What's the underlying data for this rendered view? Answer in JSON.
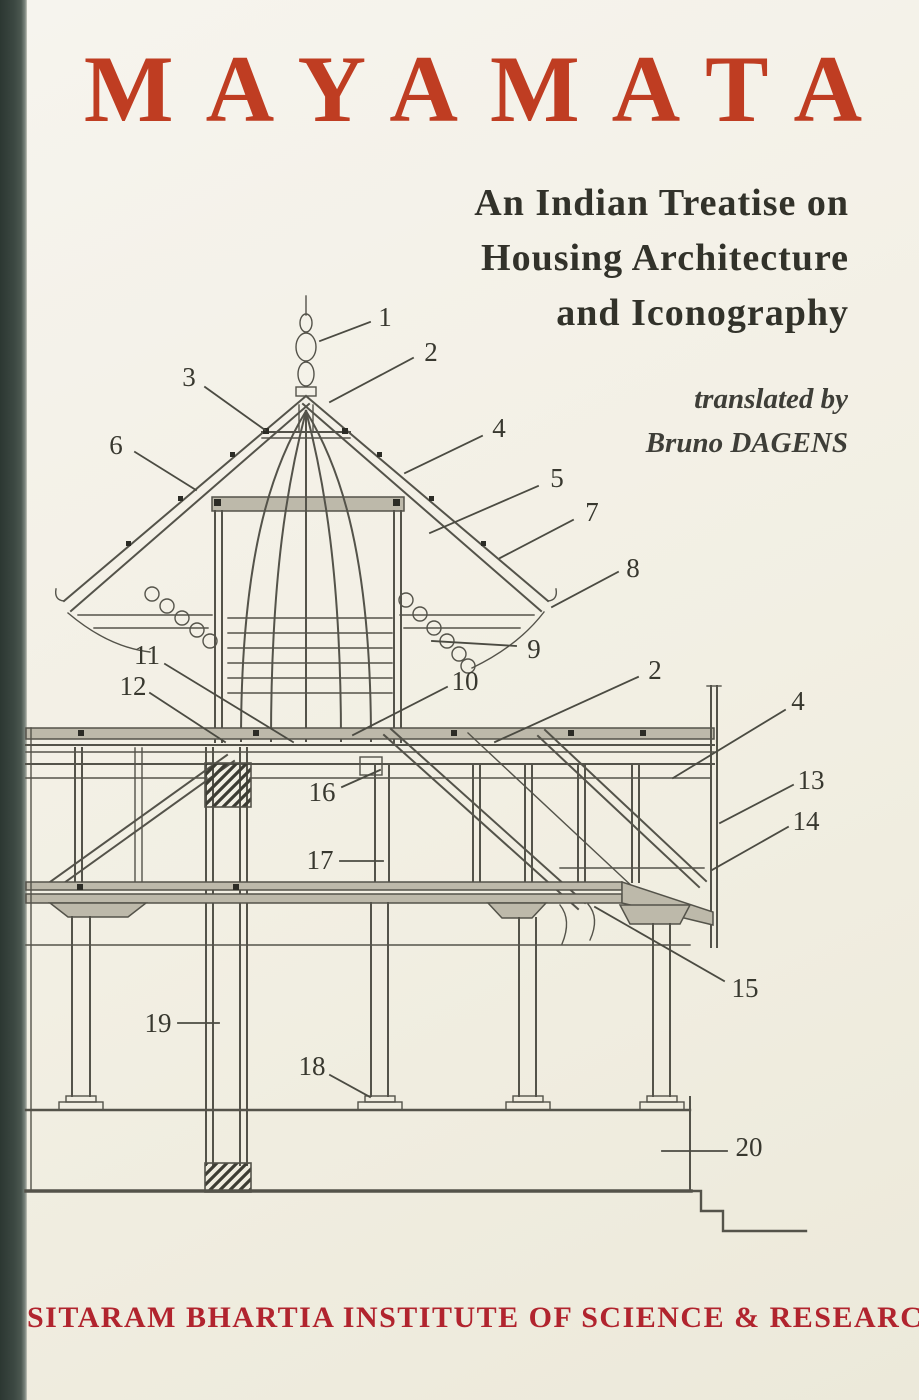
{
  "cover": {
    "title": "MAYAMATA",
    "subtitle": {
      "lines": [
        "An Indian Treatise on",
        "Housing Architecture",
        "and Iconography"
      ]
    },
    "translator": {
      "prefix": "translated by",
      "name": "Bruno DAGENS"
    },
    "publisher": "SITARAM BHARTIA INSTITUTE OF SCIENCE & RESEARCH"
  },
  "colors": {
    "background": "#f2efe3",
    "spine": "#3b4741",
    "title_red": "#bf3d22",
    "publisher_red": "#b1242e",
    "subtitle_ink": "#32322a",
    "drawing_ink": "#54534a"
  },
  "diagram": {
    "type": "architectural-cross-section",
    "subject": "Cross-section of a two-storeyed pavilion with finial, pyramidal roof, columns and plinth; construction parts numbered 1-20",
    "callouts": [
      {
        "label": "1",
        "lx": 385,
        "ly": 317,
        "x1": 370,
        "y1": 322,
        "x2": 320,
        "y2": 341
      },
      {
        "label": "2",
        "lx": 431,
        "ly": 352,
        "x1": 413,
        "y1": 358,
        "x2": 330,
        "y2": 402
      },
      {
        "label": "3",
        "lx": 189,
        "ly": 377,
        "x1": 205,
        "y1": 387,
        "x2": 265,
        "y2": 430
      },
      {
        "label": "4",
        "lx": 499,
        "ly": 428,
        "x1": 482,
        "y1": 436,
        "x2": 405,
        "y2": 473
      },
      {
        "label": "5",
        "lx": 557,
        "ly": 478,
        "x1": 538,
        "y1": 486,
        "x2": 430,
        "y2": 533
      },
      {
        "label": "6",
        "lx": 116,
        "ly": 445,
        "x1": 135,
        "y1": 452,
        "x2": 196,
        "y2": 490
      },
      {
        "label": "7",
        "lx": 592,
        "ly": 512,
        "x1": 573,
        "y1": 520,
        "x2": 500,
        "y2": 558
      },
      {
        "label": "8",
        "lx": 633,
        "ly": 568,
        "x1": 618,
        "y1": 572,
        "x2": 552,
        "y2": 607
      },
      {
        "label": "9",
        "lx": 534,
        "ly": 649,
        "x1": 516,
        "y1": 646,
        "x2": 432,
        "y2": 641
      },
      {
        "label": "10",
        "lx": 465,
        "ly": 681,
        "x1": 447,
        "y1": 687,
        "x2": 353,
        "y2": 735
      },
      {
        "label": "11",
        "lx": 147,
        "ly": 655,
        "x1": 165,
        "y1": 664,
        "x2": 293,
        "y2": 742
      },
      {
        "label": "12",
        "lx": 133,
        "ly": 686,
        "x1": 150,
        "y1": 693,
        "x2": 225,
        "y2": 742
      },
      {
        "label": "2",
        "lx": 655,
        "ly": 670,
        "x1": 638,
        "y1": 677,
        "x2": 495,
        "y2": 742
      },
      {
        "label": "4",
        "lx": 798,
        "ly": 701,
        "x1": 785,
        "y1": 710,
        "x2": 673,
        "y2": 778
      },
      {
        "label": "13",
        "lx": 811,
        "ly": 780,
        "x1": 793,
        "y1": 785,
        "x2": 720,
        "y2": 823
      },
      {
        "label": "14",
        "lx": 806,
        "ly": 821,
        "x1": 788,
        "y1": 827,
        "x2": 712,
        "y2": 870
      },
      {
        "label": "15",
        "lx": 745,
        "ly": 988,
        "x1": 724,
        "y1": 981,
        "x2": 595,
        "y2": 907
      },
      {
        "label": "16",
        "lx": 322,
        "ly": 792,
        "x1": 342,
        "y1": 787,
        "x2": 380,
        "y2": 770
      },
      {
        "label": "17",
        "lx": 320,
        "ly": 860,
        "x1": 340,
        "y1": 861,
        "x2": 383,
        "y2": 861
      },
      {
        "label": "18",
        "lx": 312,
        "ly": 1066,
        "x1": 330,
        "y1": 1075,
        "x2": 370,
        "y2": 1097
      },
      {
        "label": "19",
        "lx": 158,
        "ly": 1023,
        "x1": 178,
        "y1": 1023,
        "x2": 219,
        "y2": 1023
      },
      {
        "label": "20",
        "lx": 749,
        "ly": 1147,
        "x1": 727,
        "y1": 1151,
        "x2": 662,
        "y2": 1151
      }
    ]
  }
}
